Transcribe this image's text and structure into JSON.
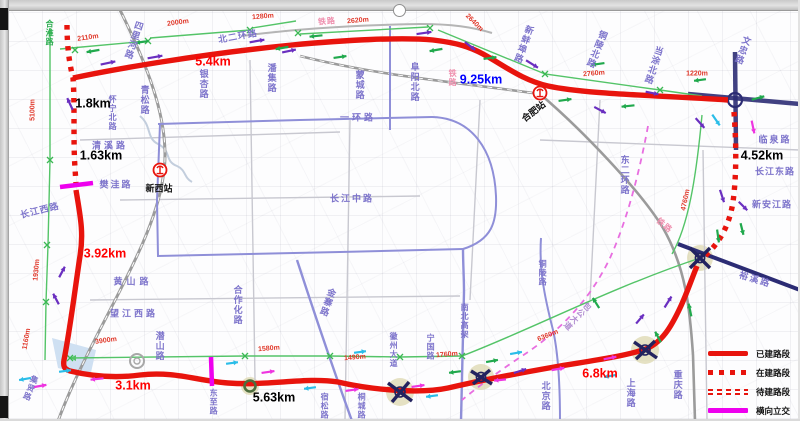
{
  "window": {
    "handle": "selection-resize-handle"
  },
  "colors": {
    "ring_red": "#e8140d",
    "magenta": "#ee00ee",
    "measure_red": "#e0382a",
    "road_purple": "#7d74cb",
    "rail_pink": "#ef8fae",
    "km_black": "#141414",
    "km_blue": "#2a28c8",
    "green_line": "#54c468",
    "arrow_purple": "#6a2fc0",
    "arrow_green": "#21a94d",
    "arrow_cyan": "#2bbde8",
    "arrow_magenta": "#ee35e0",
    "blue_road": "#8f8fd8",
    "navy_road": "#2c2c74",
    "railway_grey": "#9b9b9b"
  },
  "legend": {
    "items": [
      {
        "label": "已建路段",
        "style": "solid"
      },
      {
        "label": "在建路段",
        "style": "dotted"
      },
      {
        "label": "待建路段",
        "style": "double-dash"
      },
      {
        "label": "横向立交",
        "style": "magenta"
      }
    ]
  },
  "stations": [
    {
      "name": "新西站",
      "icon_x": 160,
      "icon_y": 170,
      "label_x": 159,
      "label_y": 189,
      "label_rot": 0
    },
    {
      "name": "合肥站",
      "icon_x": 540,
      "icon_y": 93,
      "label_x": 534,
      "label_y": 112,
      "label_rot": -38
    }
  ],
  "km_labels": [
    {
      "t": "5.4km",
      "x": 213,
      "y": 62,
      "c": "red"
    },
    {
      "t": "9.25km",
      "x": 481,
      "y": 80,
      "c": "blue"
    },
    {
      "t": "1.8km",
      "x": 93,
      "y": 104,
      "c": "black"
    },
    {
      "t": "1.63km",
      "x": 101,
      "y": 156,
      "c": "black"
    },
    {
      "t": "3.92km",
      "x": 105,
      "y": 254,
      "c": "red"
    },
    {
      "t": "3.1km",
      "x": 133,
      "y": 386,
      "c": "red"
    },
    {
      "t": "5.63km",
      "x": 274,
      "y": 398,
      "c": "black"
    },
    {
      "t": "6.8km",
      "x": 600,
      "y": 374,
      "c": "red"
    },
    {
      "t": "4.52km",
      "x": 762,
      "y": 156,
      "c": "black"
    }
  ],
  "measure_labels": [
    {
      "t": "2110m",
      "x": 88,
      "y": 38,
      "r": -8
    },
    {
      "t": "2000m",
      "x": 178,
      "y": 23,
      "r": -8
    },
    {
      "t": "1280m",
      "x": 263,
      "y": 17,
      "r": -5
    },
    {
      "t": "2620m",
      "x": 358,
      "y": 21,
      "r": -5
    },
    {
      "t": "2640m",
      "x": 474,
      "y": 23,
      "r": 45
    },
    {
      "t": "2760m",
      "x": 594,
      "y": 74,
      "r": -5
    },
    {
      "t": "1220m",
      "x": 697,
      "y": 74,
      "r": 0
    },
    {
      "t": "5100m",
      "x": 33,
      "y": 110,
      "r": -90
    },
    {
      "t": "1930m",
      "x": 37,
      "y": 270,
      "r": -85
    },
    {
      "t": "1160m",
      "x": 27,
      "y": 339,
      "r": -80
    },
    {
      "t": "3900m",
      "x": 106,
      "y": 341,
      "r": -8
    },
    {
      "t": "1580m",
      "x": 269,
      "y": 349,
      "r": -5
    },
    {
      "t": "1490m",
      "x": 355,
      "y": 358,
      "r": -5
    },
    {
      "t": "1760m",
      "x": 447,
      "y": 355,
      "r": -5
    },
    {
      "t": "6360m",
      "x": 548,
      "y": 336,
      "r": -22
    },
    {
      "t": "4760m",
      "x": 686,
      "y": 200,
      "r": -78
    }
  ],
  "rail_labels": [
    {
      "t": "铁路",
      "x": 327,
      "y": 22,
      "r": -5
    },
    {
      "t": "铁路",
      "x": 452,
      "y": 78,
      "v": 1
    },
    {
      "t": "铁路",
      "x": 664,
      "y": 226,
      "r": 40
    }
  ],
  "road_labels": [
    {
      "t": "合淮路",
      "x": 49,
      "y": 33,
      "v": 1,
      "c": "#2fae52",
      "s": 8
    },
    {
      "t": "四里河路",
      "x": 133,
      "y": 40,
      "v": 1,
      "r": 18
    },
    {
      "t": "北二环路",
      "x": 238,
      "y": 37,
      "r": -10
    },
    {
      "t": "潘集路",
      "x": 271,
      "y": 78,
      "v": 1
    },
    {
      "t": "银杏路",
      "x": 203,
      "y": 84,
      "v": 1
    },
    {
      "t": "青松路",
      "x": 144,
      "y": 100,
      "v": 1
    },
    {
      "t": "怀宁北路",
      "x": 112,
      "y": 113,
      "v": 1,
      "s": 8
    },
    {
      "t": "清溪路",
      "x": 110,
      "y": 146,
      "ls": 3
    },
    {
      "t": "樊洼路",
      "x": 116,
      "y": 185,
      "ls": 2
    },
    {
      "t": "蒙城路",
      "x": 359,
      "y": 85,
      "v": 1
    },
    {
      "t": "阜阳北路",
      "x": 414,
      "y": 82,
      "v": 1
    },
    {
      "t": "新蚌埠路",
      "x": 523,
      "y": 44,
      "v": 1,
      "r": 20
    },
    {
      "t": "铜陵北路",
      "x": 596,
      "y": 49,
      "v": 1,
      "r": 22
    },
    {
      "t": "当涂北路",
      "x": 653,
      "y": 65,
      "v": 1,
      "r": 18
    },
    {
      "t": "文忠路",
      "x": 742,
      "y": 50,
      "v": 1,
      "r": 20
    },
    {
      "t": "一环路",
      "x": 358,
      "y": 118,
      "ls": 3
    },
    {
      "t": "临泉路",
      "x": 775,
      "y": 140,
      "ls": 2
    },
    {
      "t": "长江东路",
      "x": 775,
      "y": 172,
      "ls": 1
    },
    {
      "t": "新安江路",
      "x": 772,
      "y": 205,
      "ls": 1
    },
    {
      "t": "东二环路",
      "x": 624,
      "y": 175,
      "v": 1
    },
    {
      "t": "铜陵路",
      "x": 542,
      "y": 273,
      "v": 1,
      "s": 8
    },
    {
      "t": "长江中路",
      "x": 352,
      "y": 199,
      "ls": 2
    },
    {
      "t": "长江西路",
      "x": 40,
      "y": 211,
      "r": -14,
      "ls": 1
    },
    {
      "t": "黄山路",
      "x": 133,
      "y": 282,
      "ls": 4
    },
    {
      "t": "望江西路",
      "x": 134,
      "y": 314,
      "ls": 3
    },
    {
      "t": "潜山路",
      "x": 159,
      "y": 346,
      "v": 1
    },
    {
      "t": "合作化路",
      "x": 237,
      "y": 305,
      "v": 1
    },
    {
      "t": "金寨路",
      "x": 327,
      "y": 302,
      "v": 1,
      "r": 20
    },
    {
      "t": "包公大道",
      "x": 577,
      "y": 316,
      "v": 1,
      "r": 45,
      "c": "#b08bd0",
      "s": 8
    },
    {
      "t": "南北高架",
      "x": 464,
      "y": 321,
      "v": 1,
      "s": 8
    },
    {
      "t": "宁国路",
      "x": 430,
      "y": 347,
      "v": 1,
      "s": 8
    },
    {
      "t": "徽州大道",
      "x": 393,
      "y": 350,
      "v": 1,
      "s": 8
    },
    {
      "t": "裕溪路",
      "x": 755,
      "y": 280,
      "r": 17,
      "ls": 2
    },
    {
      "t": "重庆路",
      "x": 677,
      "y": 385,
      "v": 1
    },
    {
      "t": "上海路",
      "x": 630,
      "y": 393,
      "v": 1
    },
    {
      "t": "北京路",
      "x": 545,
      "y": 396,
      "v": 1
    },
    {
      "t": "桐城路",
      "x": 361,
      "y": 406,
      "v": 1,
      "s": 8
    },
    {
      "t": "宿松路",
      "x": 324,
      "y": 406,
      "v": 1,
      "s": 8
    },
    {
      "t": "东至路",
      "x": 213,
      "y": 402,
      "v": 1,
      "s": 8
    },
    {
      "t": "集贤路",
      "x": 30,
      "y": 388,
      "v": 1,
      "r": 22,
      "s": 8
    }
  ],
  "xmarks": [
    [
      75,
      50
    ],
    [
      148,
      41
    ],
    [
      250,
      30
    ],
    [
      298,
      33
    ],
    [
      430,
      28
    ],
    [
      545,
      74
    ],
    [
      660,
      90
    ],
    [
      70,
      358
    ],
    [
      245,
      356
    ],
    [
      330,
      356
    ],
    [
      400,
      357
    ],
    [
      462,
      356
    ],
    [
      47,
      245
    ],
    [
      46,
      302
    ],
    [
      50,
      160
    ]
  ],
  "arrows": {
    "purple": [
      [
        108,
        63,
        -12,
        15
      ],
      [
        155,
        57,
        -10,
        15
      ],
      [
        70,
        104,
        -115,
        13
      ],
      [
        257,
        41,
        -10,
        15
      ],
      [
        289,
        51,
        -12,
        14
      ],
      [
        424,
        33,
        -8,
        15
      ],
      [
        470,
        46,
        38,
        13
      ],
      [
        532,
        64,
        32,
        14
      ],
      [
        600,
        110,
        28,
        13
      ],
      [
        652,
        93,
        12,
        13
      ],
      [
        700,
        123,
        48,
        13
      ],
      [
        722,
        196,
        72,
        13
      ],
      [
        743,
        206,
        45,
        12
      ],
      [
        668,
        302,
        -58,
        13
      ],
      [
        640,
        319,
        -50,
        12
      ],
      [
        62,
        272,
        -62,
        12
      ],
      [
        56,
        299,
        -118,
        12
      ],
      [
        520,
        371,
        -18,
        13
      ]
    ],
    "green": [
      [
        93,
        51,
        170,
        13
      ],
      [
        142,
        42,
        172,
        13
      ],
      [
        282,
        48,
        170,
        13
      ],
      [
        316,
        36,
        174,
        13
      ],
      [
        340,
        57,
        -8,
        13
      ],
      [
        436,
        50,
        170,
        13
      ],
      [
        490,
        58,
        -8,
        13
      ],
      [
        565,
        100,
        -8,
        13
      ],
      [
        628,
        106,
        174,
        13
      ],
      [
        598,
        64,
        172,
        13
      ],
      [
        758,
        98,
        -15,
        13
      ],
      [
        700,
        80,
        172,
        12
      ],
      [
        718,
        236,
        82,
        13
      ],
      [
        742,
        229,
        76,
        12
      ],
      [
        690,
        310,
        -102,
        13
      ],
      [
        658,
        337,
        -118,
        12
      ],
      [
        455,
        372,
        172,
        12
      ],
      [
        492,
        361,
        -10,
        12
      ],
      [
        596,
        303,
        -122,
        12
      ]
    ],
    "cyan": [
      [
        716,
        120,
        55,
        13
      ],
      [
        25,
        379,
        170,
        12
      ],
      [
        65,
        371,
        -8,
        12
      ],
      [
        232,
        363,
        -8,
        12
      ],
      [
        310,
        388,
        172,
        12
      ],
      [
        360,
        352,
        -8,
        12
      ],
      [
        432,
        396,
        172,
        12
      ],
      [
        516,
        353,
        -10,
        12
      ],
      [
        610,
        376,
        170,
        12
      ]
    ],
    "magenta": [
      [
        753,
        127,
        78,
        13
      ],
      [
        40,
        386,
        -10,
        13
      ],
      [
        97,
        379,
        174,
        13
      ],
      [
        268,
        372,
        -8,
        13
      ],
      [
        352,
        390,
        -8,
        13
      ],
      [
        418,
        386,
        -8,
        13
      ],
      [
        558,
        369,
        -10,
        13
      ],
      [
        610,
        358,
        -12,
        13
      ],
      [
        500,
        380,
        174,
        12
      ]
    ]
  }
}
